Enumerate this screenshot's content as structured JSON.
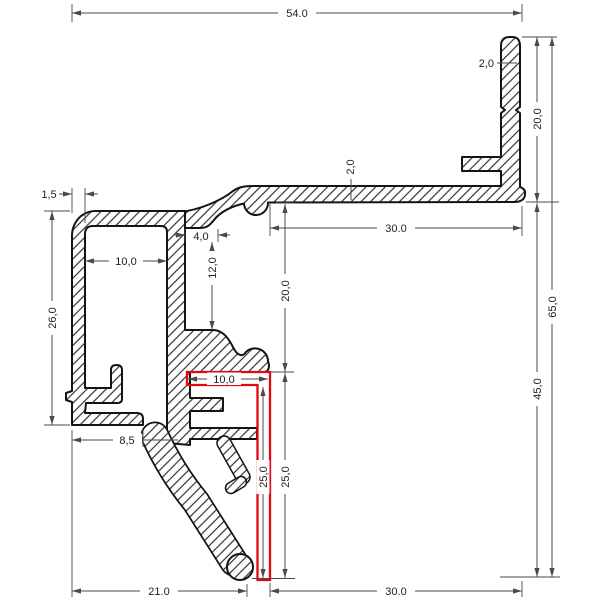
{
  "drawing": {
    "kind": "profile-cross-section-technical-drawing",
    "colors": {
      "outline": "#141414",
      "hatch": "#2b2b2b",
      "dimension_lines": "#4a4a4a",
      "highlight_red": "#e30613",
      "background": "#ffffff"
    }
  },
  "dims": {
    "top_width": "54.0",
    "flange_top": "30.0",
    "bar_thickness": "2,0",
    "bar_height": "20,0",
    "total_height": "65,0",
    "lower_height": "45,0",
    "flange_thickness": "2,0",
    "wall_thickness": "1,5",
    "box_inner_width": "10,0",
    "box_height": "26,0",
    "notch_width": "4,0",
    "notch_depth": "12,0",
    "mid_height": "20,0",
    "red_width": "10,0",
    "red_depth_inner": "25,0",
    "red_depth_outer": "25,0",
    "foot_width": "8,5",
    "bottom_left": "21.0",
    "bottom_right": "30.0"
  }
}
